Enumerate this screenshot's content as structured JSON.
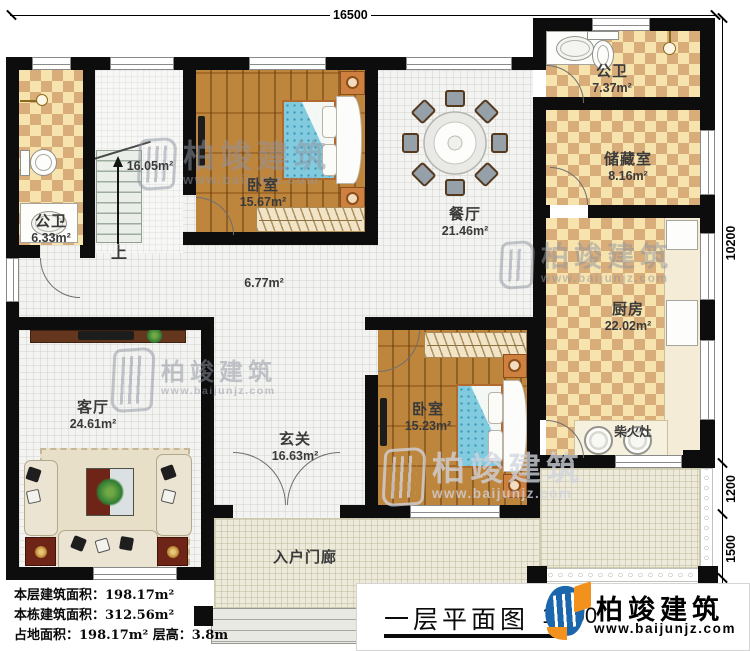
{
  "rooms": {
    "bath1": {
      "name": "公卫",
      "area": "6.33m²"
    },
    "stairwell": {
      "area": "16.05m²",
      "up_label": "上"
    },
    "bedroom1": {
      "name": "卧室",
      "area": "15.67m²"
    },
    "dining": {
      "name": "餐厅",
      "area": "21.46m²"
    },
    "hallway": {
      "area": "6.77m²"
    },
    "bath2": {
      "name": "公卫",
      "area": "7.37m²"
    },
    "storage": {
      "name": "储藏室",
      "area": "8.16m²"
    },
    "kitchen": {
      "name": "厨房",
      "area": "22.02m²"
    },
    "stove": {
      "name": "柴火灶"
    },
    "living": {
      "name": "客厅",
      "area": "24.61m²"
    },
    "foyer": {
      "name": "玄关",
      "area": "16.63m²"
    },
    "bedroom2": {
      "name": "卧室",
      "area": "15.23m²"
    },
    "porch": {
      "name": "入户门廊"
    }
  },
  "dims": {
    "top": "16500",
    "right": "10200",
    "porch_a": "1200",
    "porch_b": "1500"
  },
  "stats": {
    "floor": "本层建筑面积：198.17m²",
    "building": "本栋建筑面积：312.56m²",
    "site": "占地面积：198.17m²  层高：3.8m"
  },
  "footer": {
    "title": "一层平面图",
    "scale": "1:100"
  },
  "brand": {
    "name": "柏竣建筑",
    "url": "www.baijunjz.com"
  },
  "colors": {
    "wall": "#0d0d0d",
    "checker_dark": "#d9ad79",
    "wood": "#b5792f",
    "mattress": "#82cade",
    "logo_blue": "#1b67ad",
    "logo_orange": "#f2921d"
  }
}
